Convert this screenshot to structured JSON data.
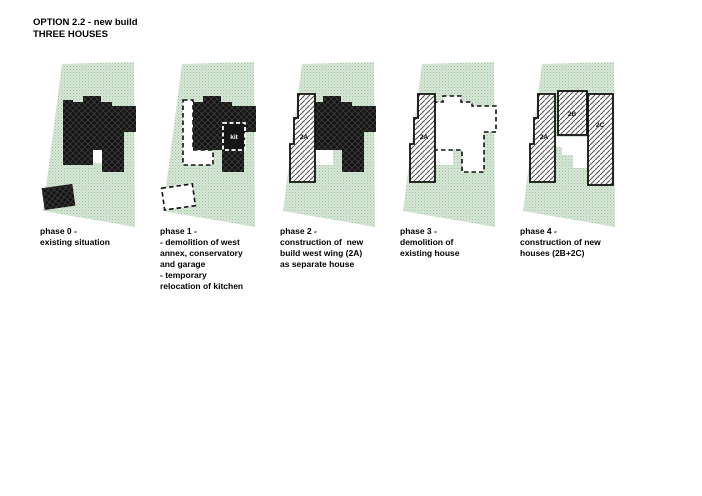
{
  "title": {
    "line1": "OPTION 2.2 - new build",
    "line2": "THREE HOUSES"
  },
  "panels": [
    {
      "id": "phase-0",
      "caption": "phase 0 -\nexisting situation",
      "labels": {}
    },
    {
      "id": "phase-1",
      "caption": "phase 1 -\n- demolition of west\nannex, conservatory\nand garage\n- temporary\nrelocation of kitchen",
      "labels": {
        "kit": "kit"
      }
    },
    {
      "id": "phase-2",
      "caption": "phase 2 -\nconstruction of  new\nbuild west wing (2A)\nas separate house",
      "labels": {
        "a2": "2A"
      }
    },
    {
      "id": "phase-3",
      "caption": "phase 3 -\ndemolition of\nexisting house",
      "labels": {
        "a2": "2A"
      }
    },
    {
      "id": "phase-4",
      "caption": "phase 4 -\nconstruction of new\nhouses (2B+2C)",
      "labels": {
        "a2": "2A",
        "b2": "2B",
        "c2": "2C"
      }
    }
  ],
  "colors": {
    "site_green_base": "#d9e7d9",
    "site_green_dot": "#9fc29f",
    "building_black": "#151515",
    "crosshatch_line": "#3a3a3a",
    "new_build_hatch_line": "#555555",
    "outline_black": "#111111",
    "demolished_fill": "#ffffff"
  }
}
